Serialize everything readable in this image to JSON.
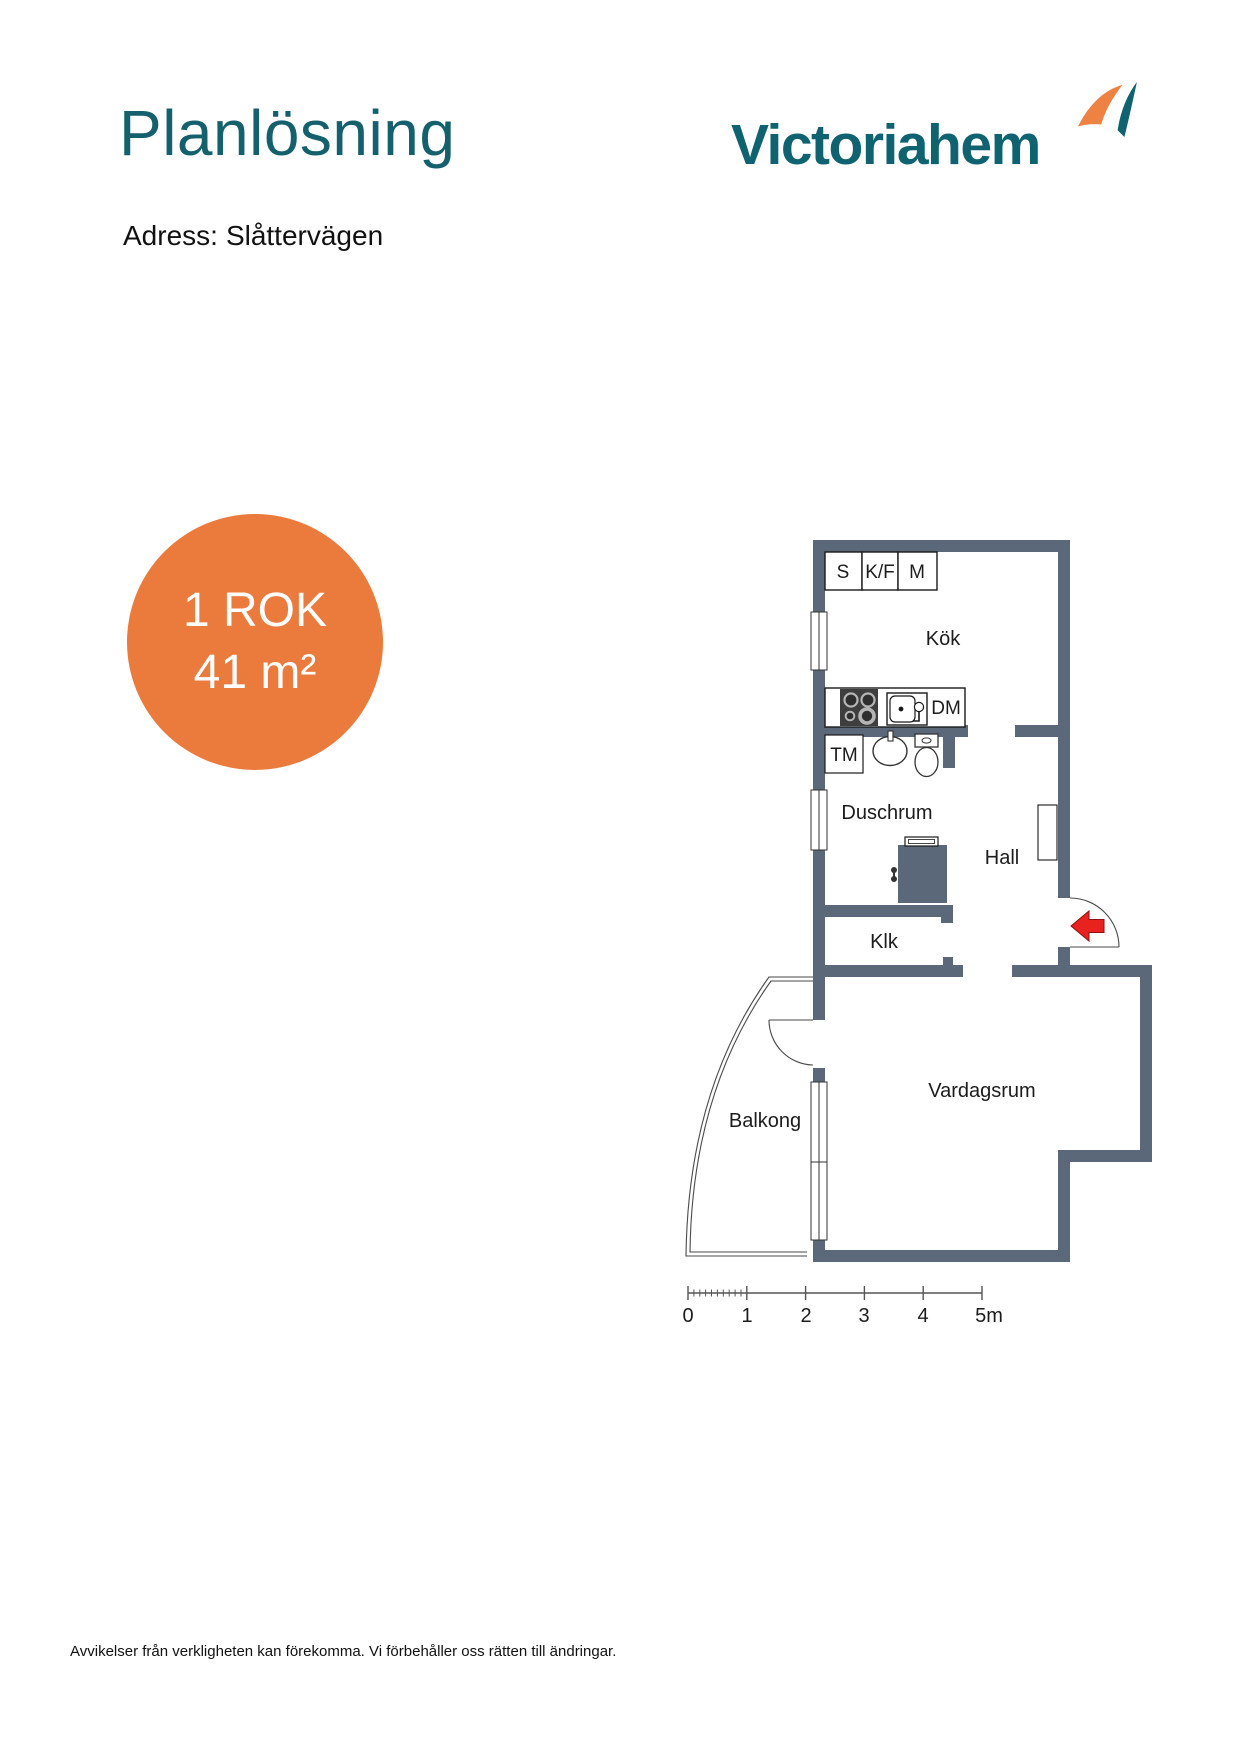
{
  "header": {
    "title": "Planlösning",
    "address_label": "Adress:",
    "address_value": "Slåttervägen",
    "logo_text": "Victoriahem"
  },
  "badge": {
    "line1": "1 ROK",
    "line2": "41 m²"
  },
  "floorplan": {
    "rooms": {
      "kitchen": "Kök",
      "shower": "Duschrum",
      "hall": "Hall",
      "closet": "Klk",
      "living": "Vardagsrum",
      "balcony": "Balkong"
    },
    "fixtures": {
      "s": "S",
      "kf": "K/F",
      "m": "M",
      "dm": "DM",
      "tm": "TM"
    },
    "scale_labels": [
      "0",
      "1",
      "2",
      "3",
      "4",
      "5m"
    ]
  },
  "footer": {
    "disclaimer": "Avvikelser från verkligheten kan förekomma. Vi förbehåller oss rätten till ändringar."
  },
  "colors": {
    "teal": "#0f6270",
    "title_teal": "#14606d",
    "badge_orange": "#eb7b3d",
    "mark_orange": "#ee8242",
    "wall_slate": "#5a6879",
    "arrow_red": "#e8221f"
  }
}
